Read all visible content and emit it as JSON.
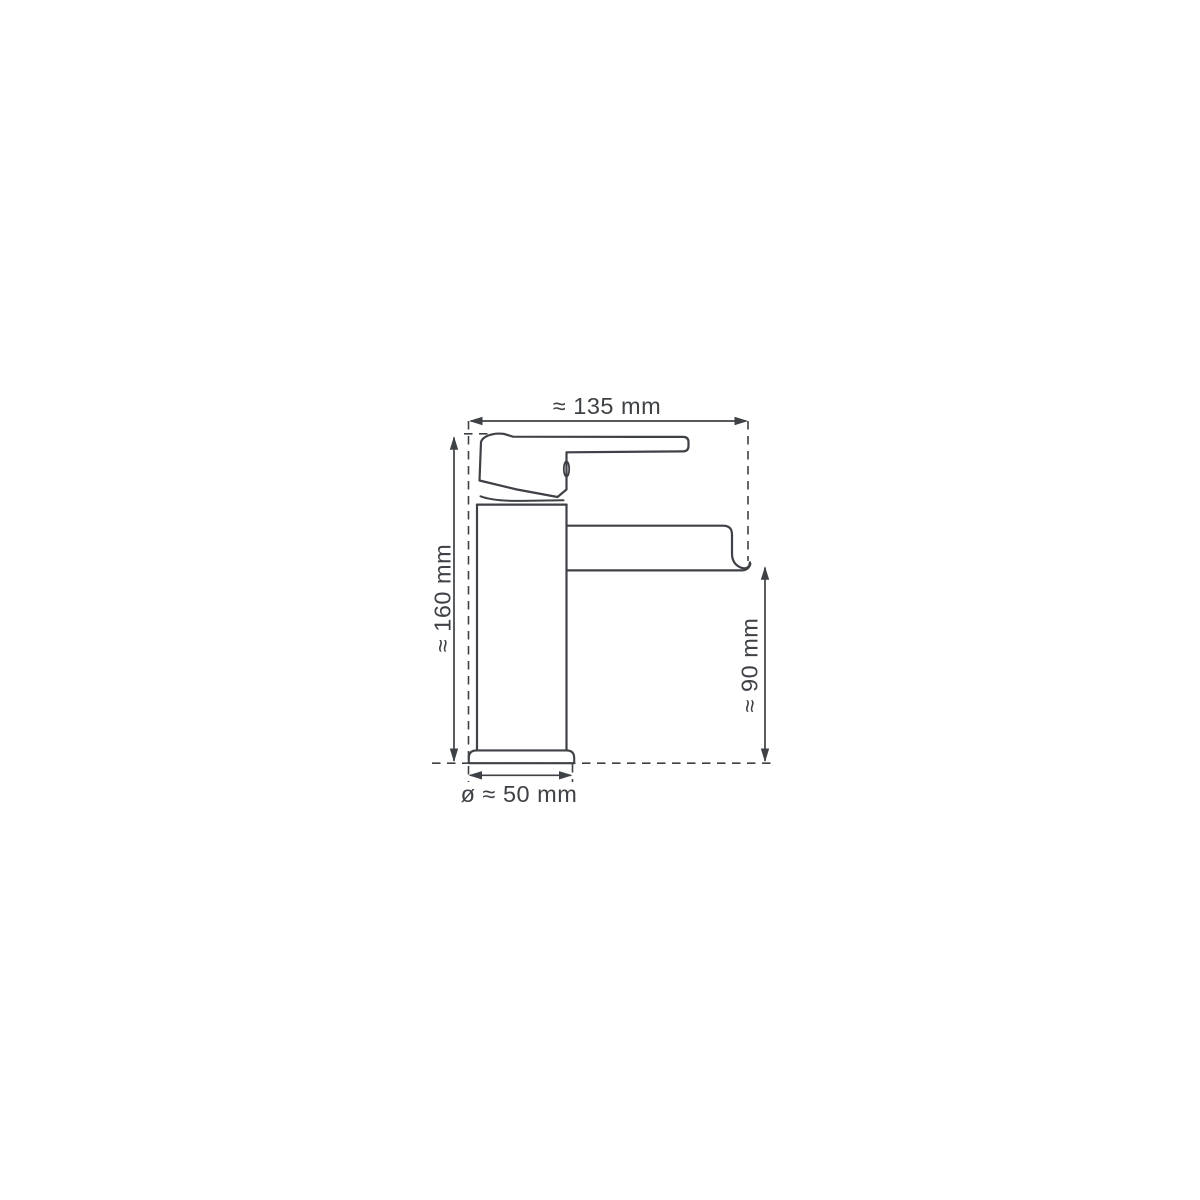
{
  "page": {
    "background_color": "#ffffff"
  },
  "drawing": {
    "line_color": "#3e4145",
    "labels": {
      "width": "≈ 135 mm",
      "height": "≈ 160 mm",
      "spout_height": "≈ 90 mm",
      "base_diameter": "ø ≈ 50 mm"
    }
  }
}
